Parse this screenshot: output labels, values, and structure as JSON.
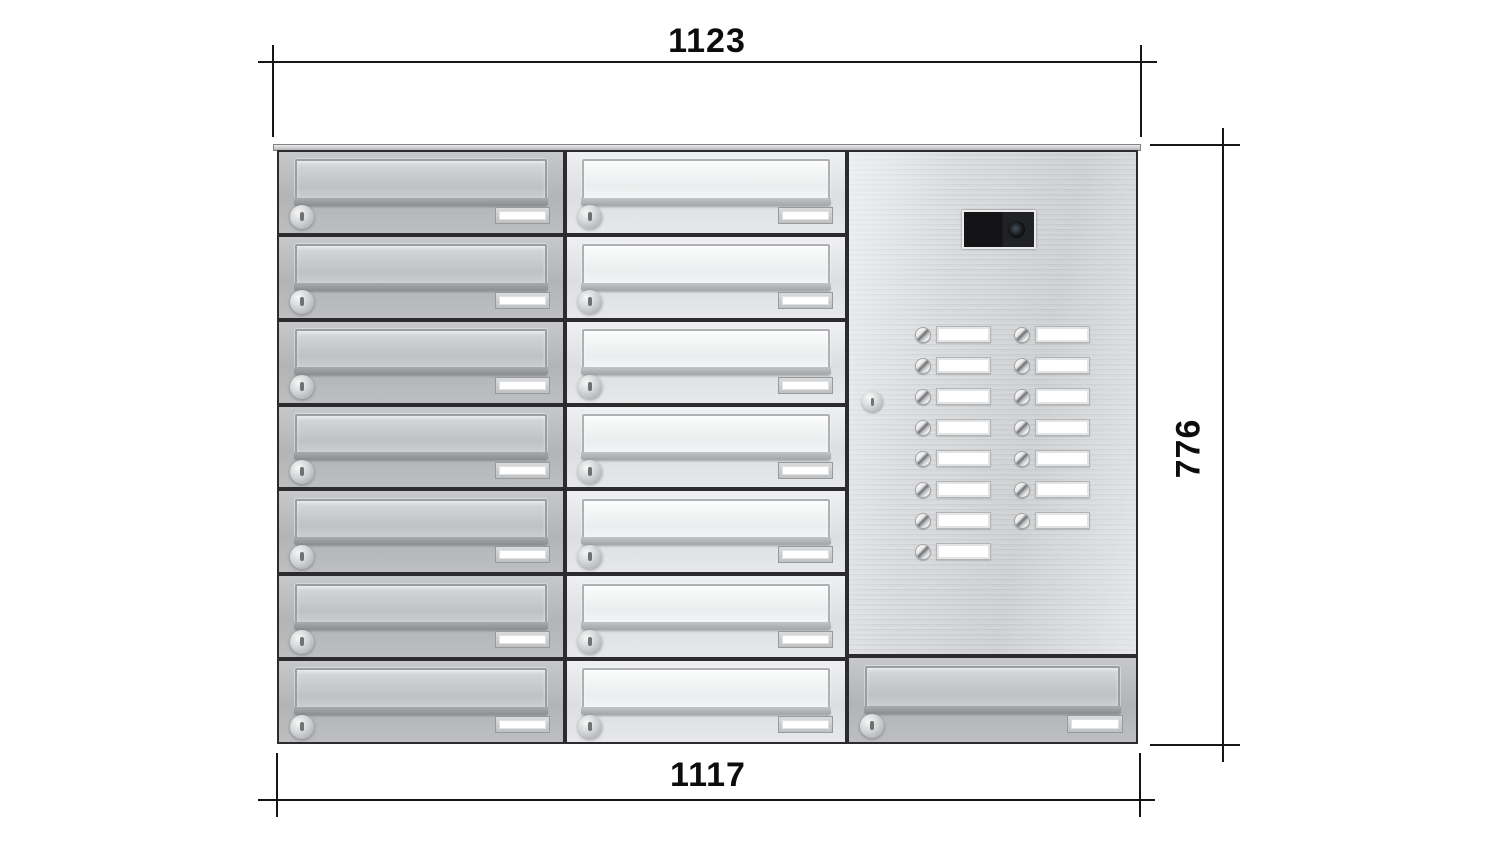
{
  "drawing": {
    "kind": "dimensioned product front view",
    "subject": "wall letterbox bank with intercom panel"
  },
  "dimensions": {
    "top": "1123",
    "right": "776",
    "bottom": "1117"
  },
  "unit": {
    "total_mailboxes": 15,
    "total_bell_buttons": 15,
    "columns": [
      {
        "id": "left",
        "kind": "mailboxes",
        "count": 7,
        "finish": "grey"
      },
      {
        "id": "middle",
        "kind": "mailboxes",
        "count": 7,
        "finish": "light"
      },
      {
        "id": "right",
        "kind": "intercom",
        "finish": "grey",
        "mailboxes_below": 1,
        "intercom": {
          "camera": true,
          "lock": true,
          "bells_left": 8,
          "bells_right": 7
        }
      }
    ],
    "mailbox_parts": [
      "letter-flap",
      "lock-cylinder",
      "name-plate"
    ],
    "icons": [
      "camera-lens",
      "lock-cylinder",
      "bell-button",
      "name-plate"
    ]
  },
  "colors": {
    "background": "#ffffff",
    "dimension_line": "#161616",
    "dimension_text": "#0d0d0d",
    "box_border": "#2c2c2e",
    "box_face_grey": "#b7b9bb",
    "box_face_light": "#e4e6e8",
    "panel_steel": "#d6d8da",
    "nameplate_white": "#ffffff",
    "camera_black": "#17181a"
  }
}
